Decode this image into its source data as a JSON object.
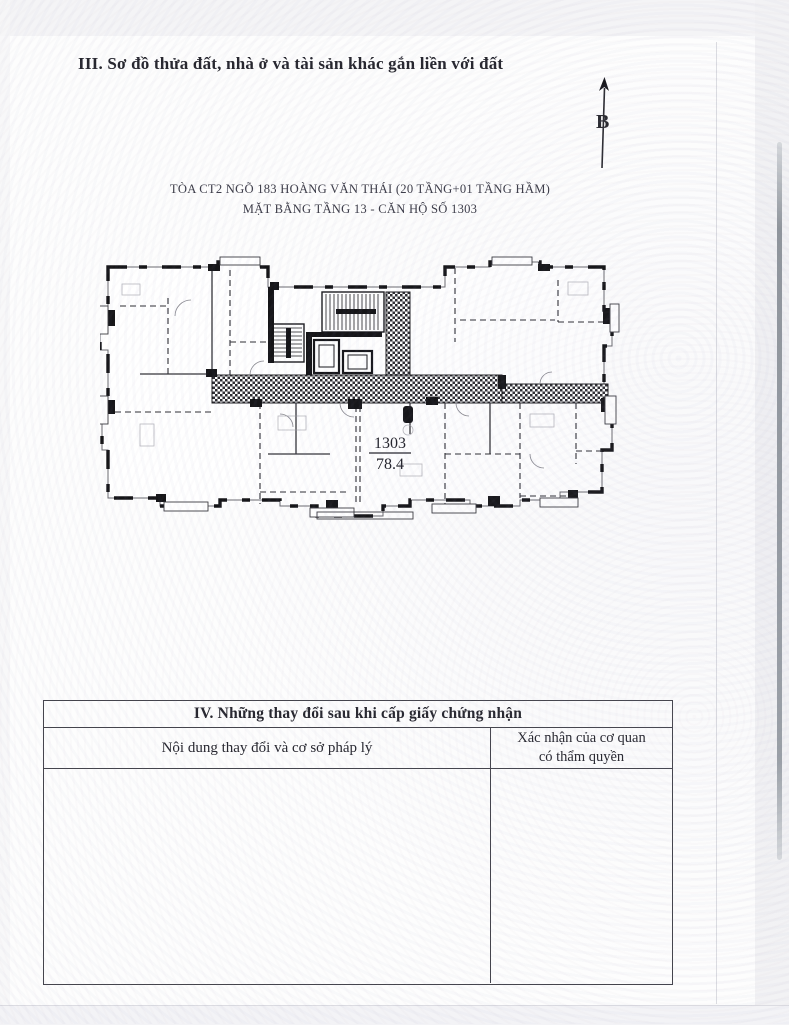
{
  "document": {
    "section3_title": "III. Sơ đồ thửa đất, nhà ở và tài sản khác gắn liền với đất",
    "compass_label": "B",
    "floor_plan": {
      "title_line1": "TÒA CT2 NGÕ 183 HOÀNG VĂN THÁI (20 TẦNG+01 TẦNG HẦM)",
      "title_line2": "MẶT BẰNG TẦNG 13 - CĂN HỘ SỐ 1303",
      "apartment_number": "1303",
      "apartment_area": "78.4"
    },
    "section4": {
      "title": "IV. Những thay đổi sau khi cấp giấy chứng nhận",
      "col1_header": "Nội dung thay đổi và cơ sở pháp lý",
      "col2_header_line1": "Xác nhận của cơ quan",
      "col2_header_line2": "có thẩm quyền"
    }
  }
}
